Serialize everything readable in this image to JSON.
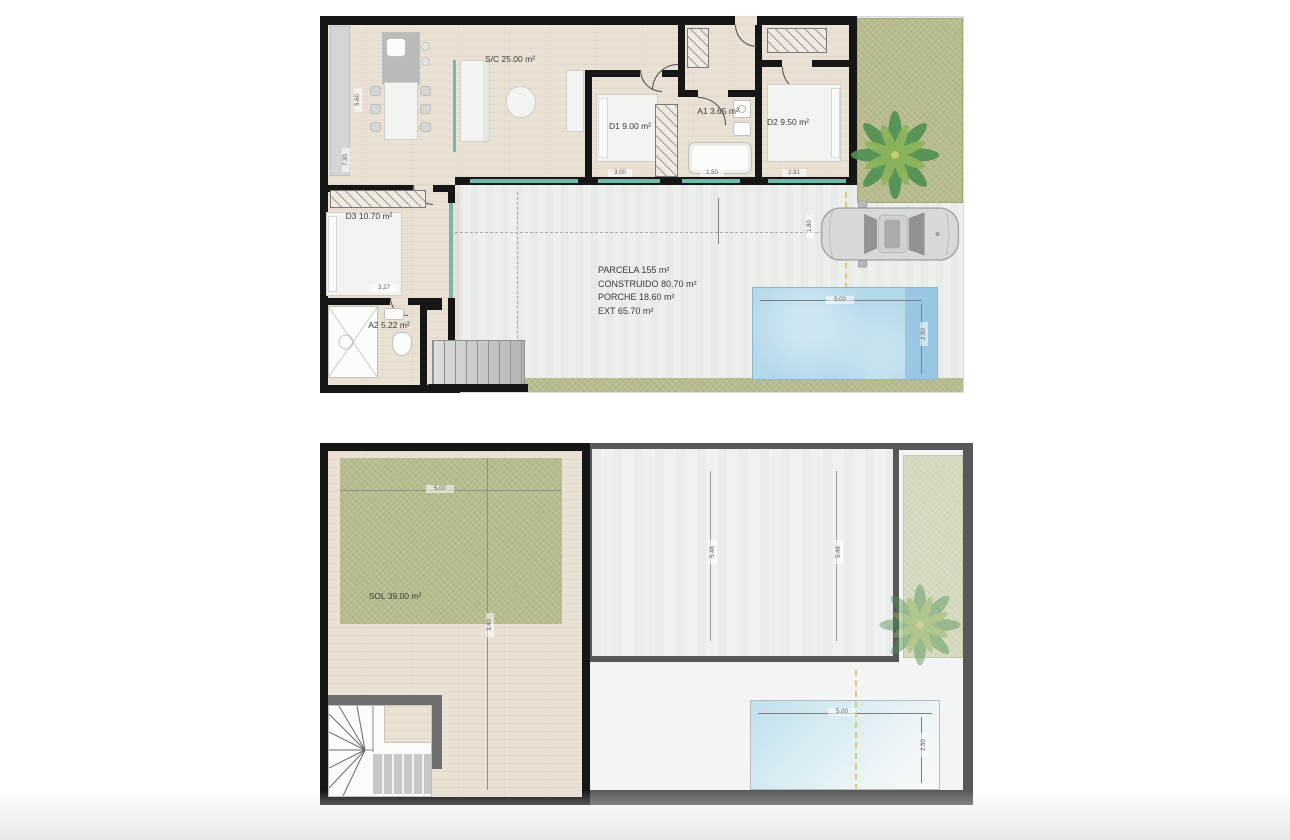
{
  "colors": {
    "wall": "#161616",
    "roof_wall": "#585858",
    "wood_floor": "#e9e1d4",
    "terrace": "#edefec",
    "grass": "#b7bb8d",
    "grass_faded": "#d6d9bf",
    "pool_blue": "#b3d8ea",
    "pool_blue_dark": "#93c3e2",
    "window_teal": "#74b7ad",
    "axis_yellow": "#d8cd6e"
  },
  "ground_floor": {
    "rooms": {
      "living": "S/C 25.00 m²",
      "bedroom1": "D1 9.00 m²",
      "bath1": "A1 3.65 m²",
      "bedroom2": "D2 9.50 m²",
      "bedroom3": "D3 10.70 m²",
      "bath2": "A2 5.22 m²"
    },
    "summary": [
      "PARCELA 155 m²",
      "CONSTRUIDO 80.70 m²",
      "PORCHE 18.60 m²",
      "EXT 65.70 m²"
    ],
    "dims": {
      "d1_width": "3.00",
      "a1_width": "1.50",
      "d2_width": "2.91",
      "d3_width": "3.27",
      "facade_a": "5.60",
      "facade_b": "7.30",
      "pool_width": "5.00",
      "pool_depth": "2.50",
      "car_offset": "1.80"
    }
  },
  "roof": {
    "solarium": "SOL 39.00 m²",
    "dims": {
      "sol_width": "5.00",
      "sol_depth": "3.40",
      "roof_a": "5.48",
      "roof_b": "5.48",
      "pool_width": "5.00",
      "pool_depth": "2.50"
    }
  }
}
